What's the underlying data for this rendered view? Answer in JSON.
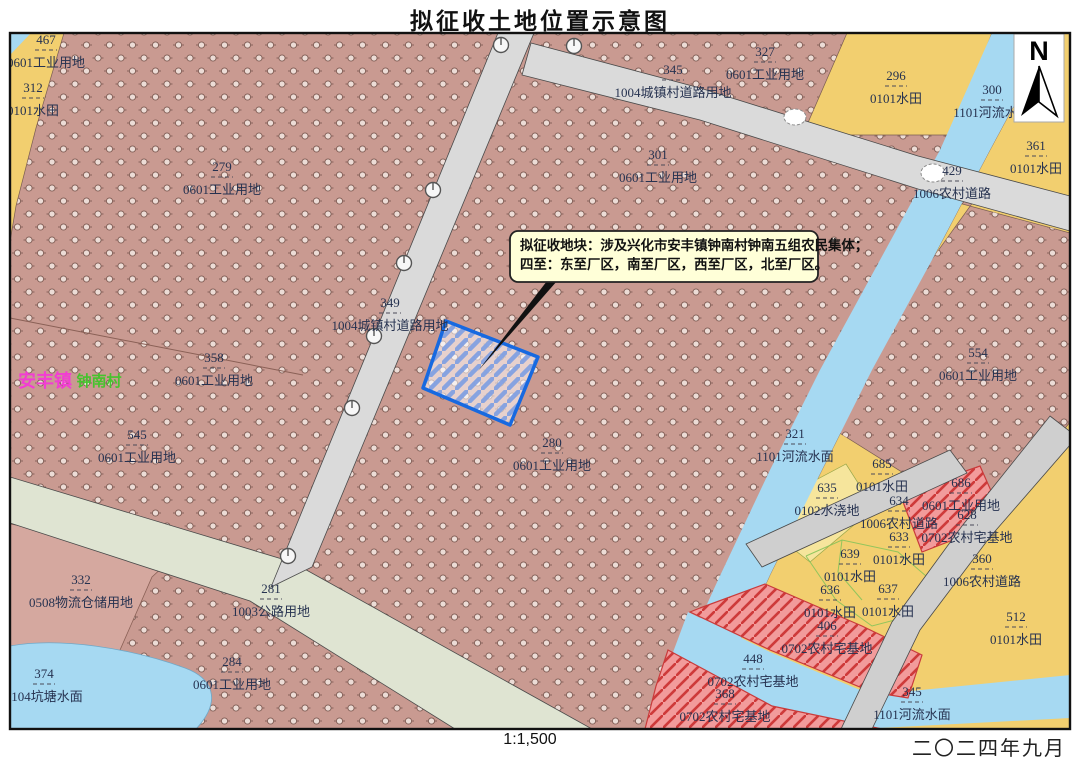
{
  "title": "拟征收土地位置示意图",
  "scale_text": "1:1,500",
  "date_text": "二〇二四年九月",
  "north_label": "N",
  "annotation": {
    "line1": "拟征收地块：涉及兴化市安丰镇钟南村钟南五组农民集体；",
    "line2": "四至：东至厂区，南至厂区，西至厂区，北至厂区。"
  },
  "colors": {
    "industrial_pink": "#c99a91",
    "plain_pink": "#d5a89f",
    "paddy_yellow": "#f2cf6f",
    "irrigated_pale_yellow": "#f6e59c",
    "river_blue": "#a6d9f2",
    "road_grey": "#dadada",
    "highway_grey_green": "#dfe4d2",
    "homestead_red_fill": "#f29b9b",
    "homestead_red_line": "#ce3a3a",
    "target_border_blue": "#1769e0",
    "town_label_magenta": "#f23dd3",
    "village_label_green": "#46c32e",
    "label_text": "#263250"
  },
  "map": {
    "parcel_labels": [
      {
        "n": "467",
        "t": "0601工业用地",
        "x": 46,
        "y": 44
      },
      {
        "n": "312",
        "t": "0101水田",
        "x": 33,
        "y": 92
      },
      {
        "n": "279",
        "t": "0601工业用地",
        "x": 222,
        "y": 171
      },
      {
        "n": "345",
        "t": "1004城镇村道路用地",
        "x": 673,
        "y": 74
      },
      {
        "n": "327",
        "t": "0601工业用地",
        "x": 765,
        "y": 56
      },
      {
        "n": "301",
        "t": "0601工业用地",
        "x": 658,
        "y": 159
      },
      {
        "n": "296",
        "t": "0101水田",
        "x": 896,
        "y": 80
      },
      {
        "n": "300",
        "t": "1101河流水面",
        "x": 992,
        "y": 94
      },
      {
        "n": "361",
        "t": "0101水田",
        "x": 1036,
        "y": 150
      },
      {
        "n": "429",
        "t": "1006农村道路",
        "x": 952,
        "y": 175
      },
      {
        "n": "349",
        "t": "1004城镇村道路用地",
        "x": 390,
        "y": 307
      },
      {
        "n": "358",
        "t": "0601工业用地",
        "x": 214,
        "y": 362
      },
      {
        "n": "545",
        "t": "0601工业用地",
        "x": 137,
        "y": 439
      },
      {
        "n": "554",
        "t": "0601工业用地",
        "x": 978,
        "y": 357
      },
      {
        "n": "321",
        "t": "1101河流水面",
        "x": 795,
        "y": 438
      },
      {
        "n": "280",
        "t": "0601工业用地",
        "x": 552,
        "y": 447
      },
      {
        "n": "685",
        "t": "0101水田",
        "x": 882,
        "y": 468
      },
      {
        "n": "635",
        "t": "0102水浇地",
        "x": 827,
        "y": 492
      },
      {
        "n": "634",
        "t": "1006农村道路",
        "x": 899,
        "y": 505
      },
      {
        "n": "686",
        "t": "0601工业用地",
        "x": 961,
        "y": 487
      },
      {
        "n": "628",
        "t": "0702农村宅基地",
        "x": 967,
        "y": 519
      },
      {
        "n": "633",
        "t": "0101水田",
        "x": 899,
        "y": 541
      },
      {
        "n": "360",
        "t": "1006农村道路",
        "x": 982,
        "y": 563
      },
      {
        "n": "639",
        "t": "0101水田",
        "x": 850,
        "y": 558
      },
      {
        "n": "637",
        "t": "0101水田",
        "x": 888,
        "y": 593
      },
      {
        "n": "636",
        "t": "0101水田",
        "x": 830,
        "y": 594
      },
      {
        "n": "406",
        "t": "0702农村宅基地",
        "x": 827,
        "y": 630
      },
      {
        "n": "512",
        "t": "0101水田",
        "x": 1016,
        "y": 621
      },
      {
        "n": "448",
        "t": "0702农村宅基地",
        "x": 753,
        "y": 663
      },
      {
        "n": "368",
        "t": "0702农村宅基地",
        "x": 725,
        "y": 698
      },
      {
        "n": "345",
        "t": "1101河流水面",
        "x": 912,
        "y": 696
      },
      {
        "n": "332",
        "t": "0508物流仓储用地",
        "x": 81,
        "y": 584
      },
      {
        "n": "374",
        "t": "1104坑塘水面",
        "x": 44,
        "y": 678
      },
      {
        "n": "281",
        "t": "1003公路用地",
        "x": 271,
        "y": 593
      },
      {
        "n": "284",
        "t": "0601工业用地",
        "x": 232,
        "y": 666
      }
    ],
    "place_labels": [
      {
        "text": "安丰镇",
        "x": 45,
        "y": 387,
        "color": "#f23dd3",
        "size": 18
      },
      {
        "text": "钟南村",
        "x": 99,
        "y": 386,
        "color": "#46c32e",
        "size": 15
      }
    ]
  }
}
